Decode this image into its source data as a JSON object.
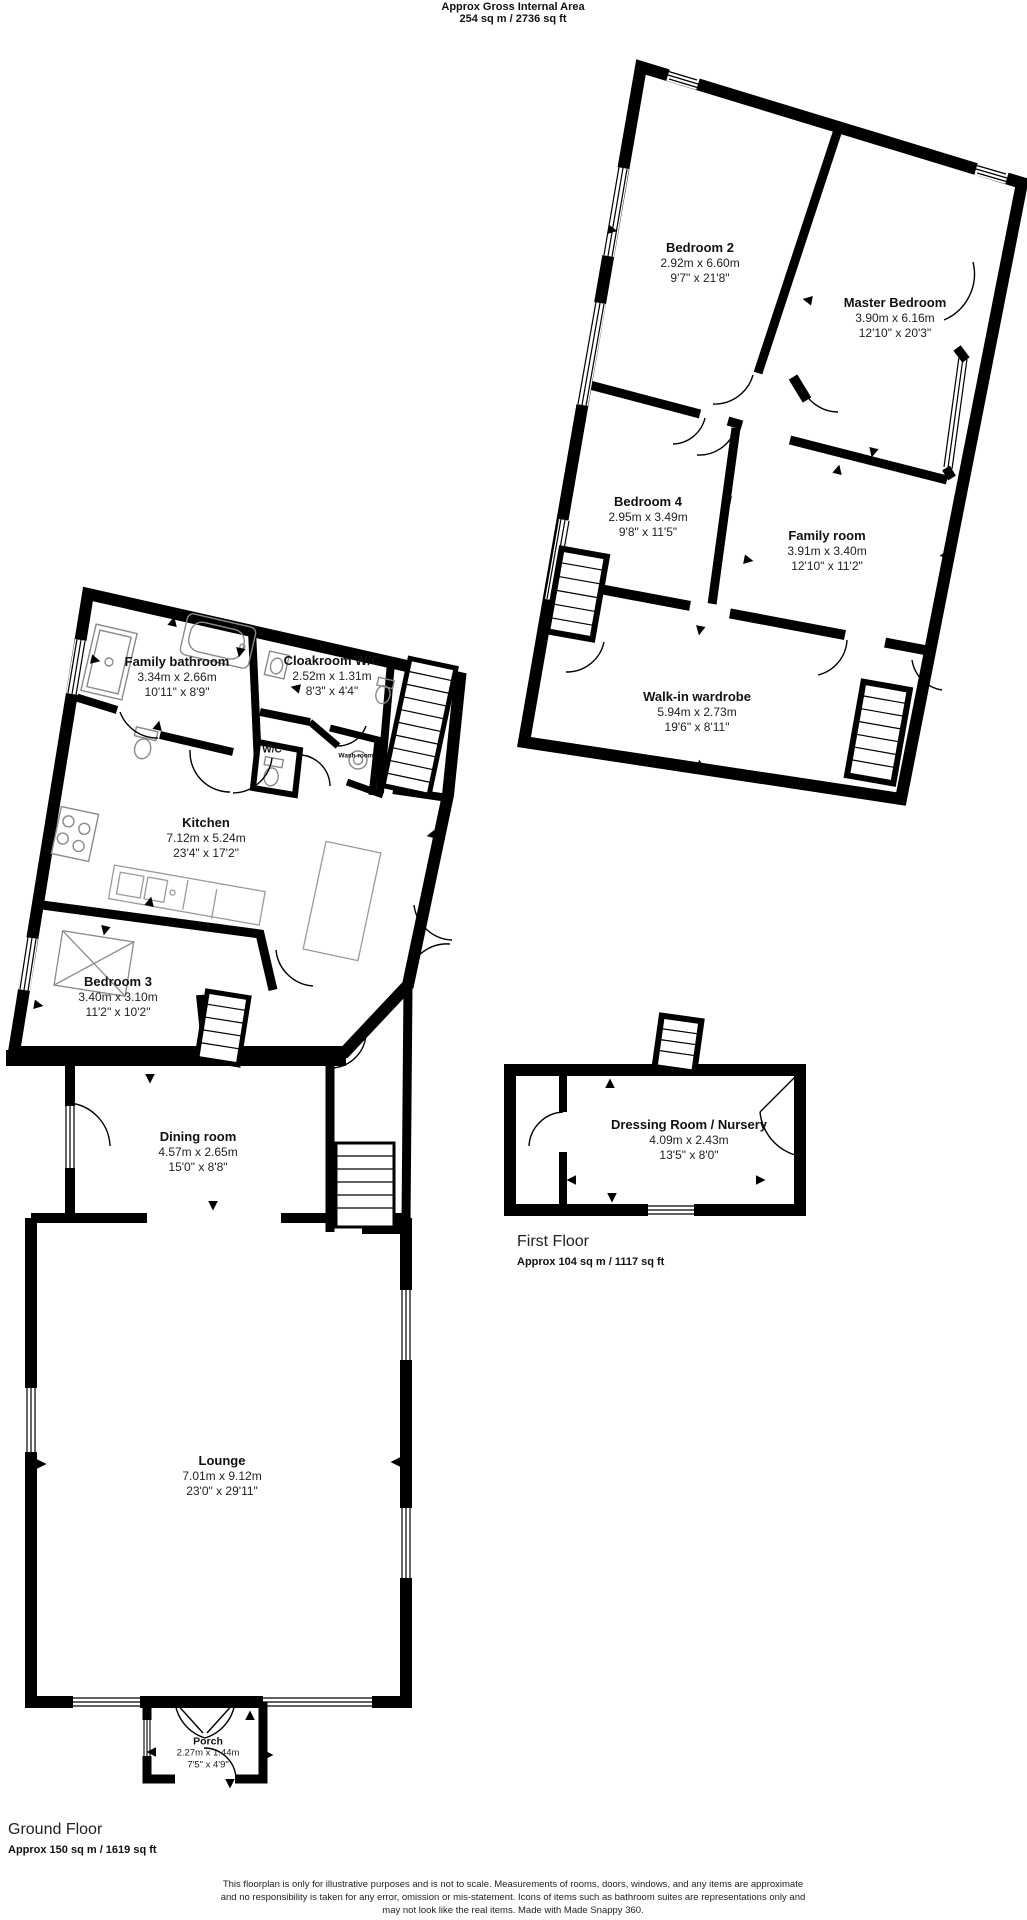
{
  "header": {
    "line1": "Approx Gross Internal Area",
    "line2": "254 sq m / 2736 sq ft"
  },
  "first_floor": {
    "label": "First Floor",
    "area": "Approx 104 sq m / 1117 sq ft",
    "rooms": [
      {
        "name": "Bedroom 2",
        "metric": "2.92m x 6.60m",
        "imperial": "9'7\" x 21'8\""
      },
      {
        "name": "Master Bedroom",
        "metric": "3.90m x 6.16m",
        "imperial": "12'10\" x 20'3\""
      },
      {
        "name": "Bedroom 4",
        "metric": "2.95m x 3.49m",
        "imperial": "9'8\" x 11'5\""
      },
      {
        "name": "Family room",
        "metric": "3.91m x 3.40m",
        "imperial": "12'10\" x 11'2\""
      },
      {
        "name": "Walk-in wardrobe",
        "metric": "5.94m x 2.73m",
        "imperial": "19'6\" x 8'11\""
      },
      {
        "name": "Dressing Room / Nursery",
        "metric": "4.09m x 2.43m",
        "imperial": "13'5\" x 8'0\""
      }
    ]
  },
  "ground_floor": {
    "label": "Ground Floor",
    "area": "Approx 150 sq m / 1619 sq ft",
    "rooms": [
      {
        "name": "Family bathroom",
        "metric": "3.34m x 2.66m",
        "imperial": "10'11\" x 8'9\""
      },
      {
        "name": "Cloakroom W/C",
        "metric": "2.52m x 1.31m",
        "imperial": "8'3\" x 4'4\""
      },
      {
        "name": "Kitchen",
        "metric": "7.12m x 5.24m",
        "imperial": "23'4\" x 17'2\""
      },
      {
        "name": "Bedroom 3",
        "metric": "3.40m x 3.10m",
        "imperial": "11'2\" x 10'2\""
      },
      {
        "name": "Dining room",
        "metric": "4.57m x 2.65m",
        "imperial": "15'0\" x 8'8\""
      },
      {
        "name": "Lounge",
        "metric": "7.01m x 9.12m",
        "imperial": "23'0\" x 29'11\""
      },
      {
        "name": "Porch",
        "metric": "2.27m x 1.44m",
        "imperial": "7'5\" x 4'9\""
      }
    ],
    "small_labels": {
      "wc": "W/C",
      "wash_room": "Wash room"
    }
  },
  "footer": {
    "line1": "This floorplan is only for illustrative purposes and is not to scale. Measurements of rooms, doors, windows, and any items are approximate",
    "line2": "and no responsibility is taken for any error, omission or mis-statement. Icons of items such as bathroom suites are representations only and",
    "line3": "may not look like the real items. Made with Made Snappy 360."
  },
  "colors": {
    "wall": "#000000",
    "text": "#1a1a1a",
    "fixture": "#8a8a8a"
  }
}
